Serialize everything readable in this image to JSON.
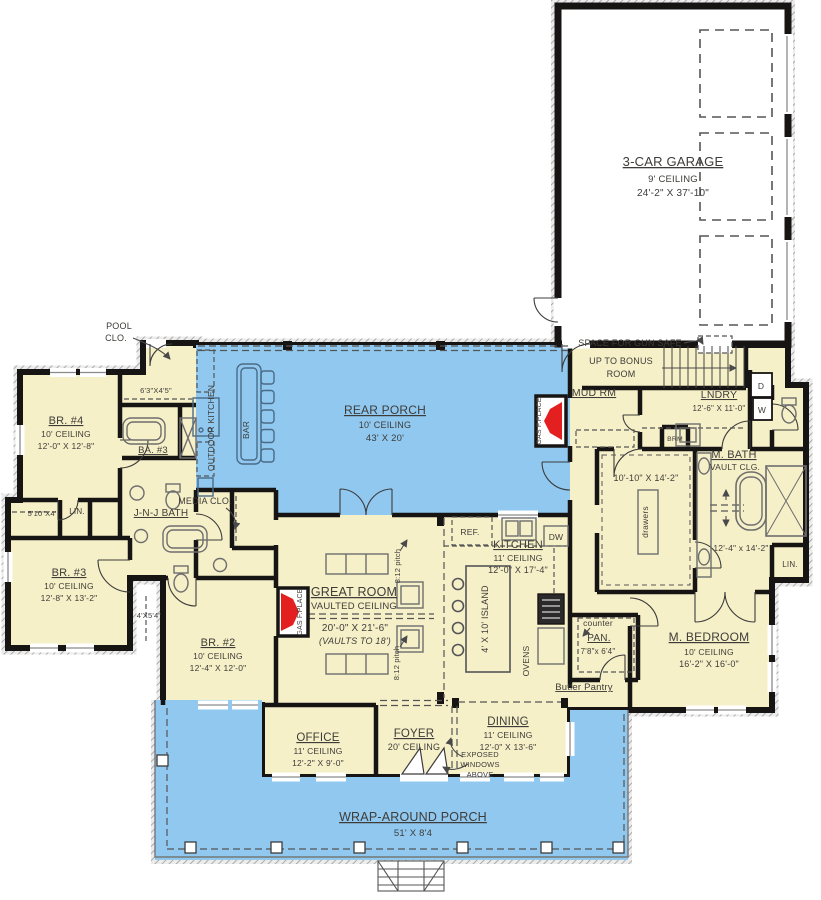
{
  "colors": {
    "room_fill": "#F6F0C9",
    "porch_fill": "#90C8F0",
    "garage_fill": "#FFFFFF",
    "wall": "#171513",
    "fireplace_red": "#E3201F",
    "text": "#3E3C38"
  },
  "rooms": {
    "garage": {
      "name": "3-CAR GARAGE",
      "ceiling": "9' CEILING",
      "dims": "24'-2\" X 37'-10\""
    },
    "rear_porch": {
      "name": "REAR PORCH",
      "ceiling": "10' CEILING",
      "dims": "43' X 20'"
    },
    "wrap_porch": {
      "name": "WRAP-AROUND PORCH",
      "dims": "51' X 8'4"
    },
    "great_room": {
      "name": "GREAT ROOM",
      "ceiling": "VAULTED CEILING",
      "dims": "20'-0\" X 21'-6\"",
      "note": "(VAULTS TO 18')"
    },
    "kitchen": {
      "name": "KITCHEN",
      "ceiling": "11' CEILING",
      "dims": "12'-0\" X 17'-4\""
    },
    "dining": {
      "name": "DINING",
      "ceiling": "11' CEILING",
      "dims": "12'-0\" X 13'-6\""
    },
    "foyer": {
      "name": "FOYER",
      "ceiling": "20' CEILING"
    },
    "office": {
      "name": "OFFICE",
      "ceiling": "11' CEILING",
      "dims": "12'-2\" X 9'-0\""
    },
    "master_bedroom": {
      "name": "M. BEDROOM",
      "ceiling": "10' CEILING",
      "dims": "16'-2\" X 16'-0\""
    },
    "master_bath": {
      "name": "M. BATH",
      "ceiling": "VAULT CLG.",
      "dims": "12'-4\" x 14'-2\""
    },
    "master_closet": {
      "dims": "10'-10\" X 14'-2\"",
      "feature": "drawers"
    },
    "bedroom2": {
      "name": "BR. #2",
      "ceiling": "10' CEILING",
      "dims": "12'-4\" X 12'-0\""
    },
    "bedroom3": {
      "name": "BR. #3",
      "ceiling": "10' CEILING",
      "dims": "12'-8\" X 13'-2\""
    },
    "bedroom4": {
      "name": "BR. #4",
      "ceiling": "10' CEILING",
      "dims": "12'-0\" X 12'-8\""
    },
    "bath3": {
      "name": "BA. #3"
    },
    "jnj_bath": {
      "name": "J-N-J BATH"
    },
    "laundry": {
      "name": "LNDRY",
      "dims": "12'-6\" X 11'-0\""
    },
    "mud_room": {
      "name": "MUD RM"
    },
    "pantry": {
      "name": "PAN.",
      "dims": "7'8\"x 6'4\""
    },
    "butler_pantry": {
      "name": "Butler Pantry"
    },
    "media_closet": {
      "name": "MEDIA CLO."
    },
    "pool_closet": {
      "line1": "POOL",
      "line2": "CLO."
    }
  },
  "annotations": {
    "gun_safe": "SPACE FOR GUN SAFE",
    "bonus_line1": "UP TO BONUS",
    "bonus_line2": "ROOM",
    "outdoor_kitchen": "OUTDOOR KITCHEN",
    "bar": "BAR",
    "gas_fireplace": "GAS F.PLACE",
    "roof_pitch": "8:12 pitch",
    "island": "4' X 10' ISLAND",
    "counter": "counter",
    "exposed_line1": "EXPOSED",
    "exposed_line2": "WINDOWS",
    "exposed_line3": "ABOVE",
    "closet_63x45": "6'3\"X4'5\"",
    "closet_510x4": "5'10\"X4'",
    "closet_4x54": "4'X5'4\"",
    "linen": "LIN."
  },
  "appliances": {
    "fridge": "REF.",
    "dishwasher": "DW",
    "ovens": "OVENS",
    "dryer": "D",
    "washer": "W",
    "broom": "BRM"
  }
}
